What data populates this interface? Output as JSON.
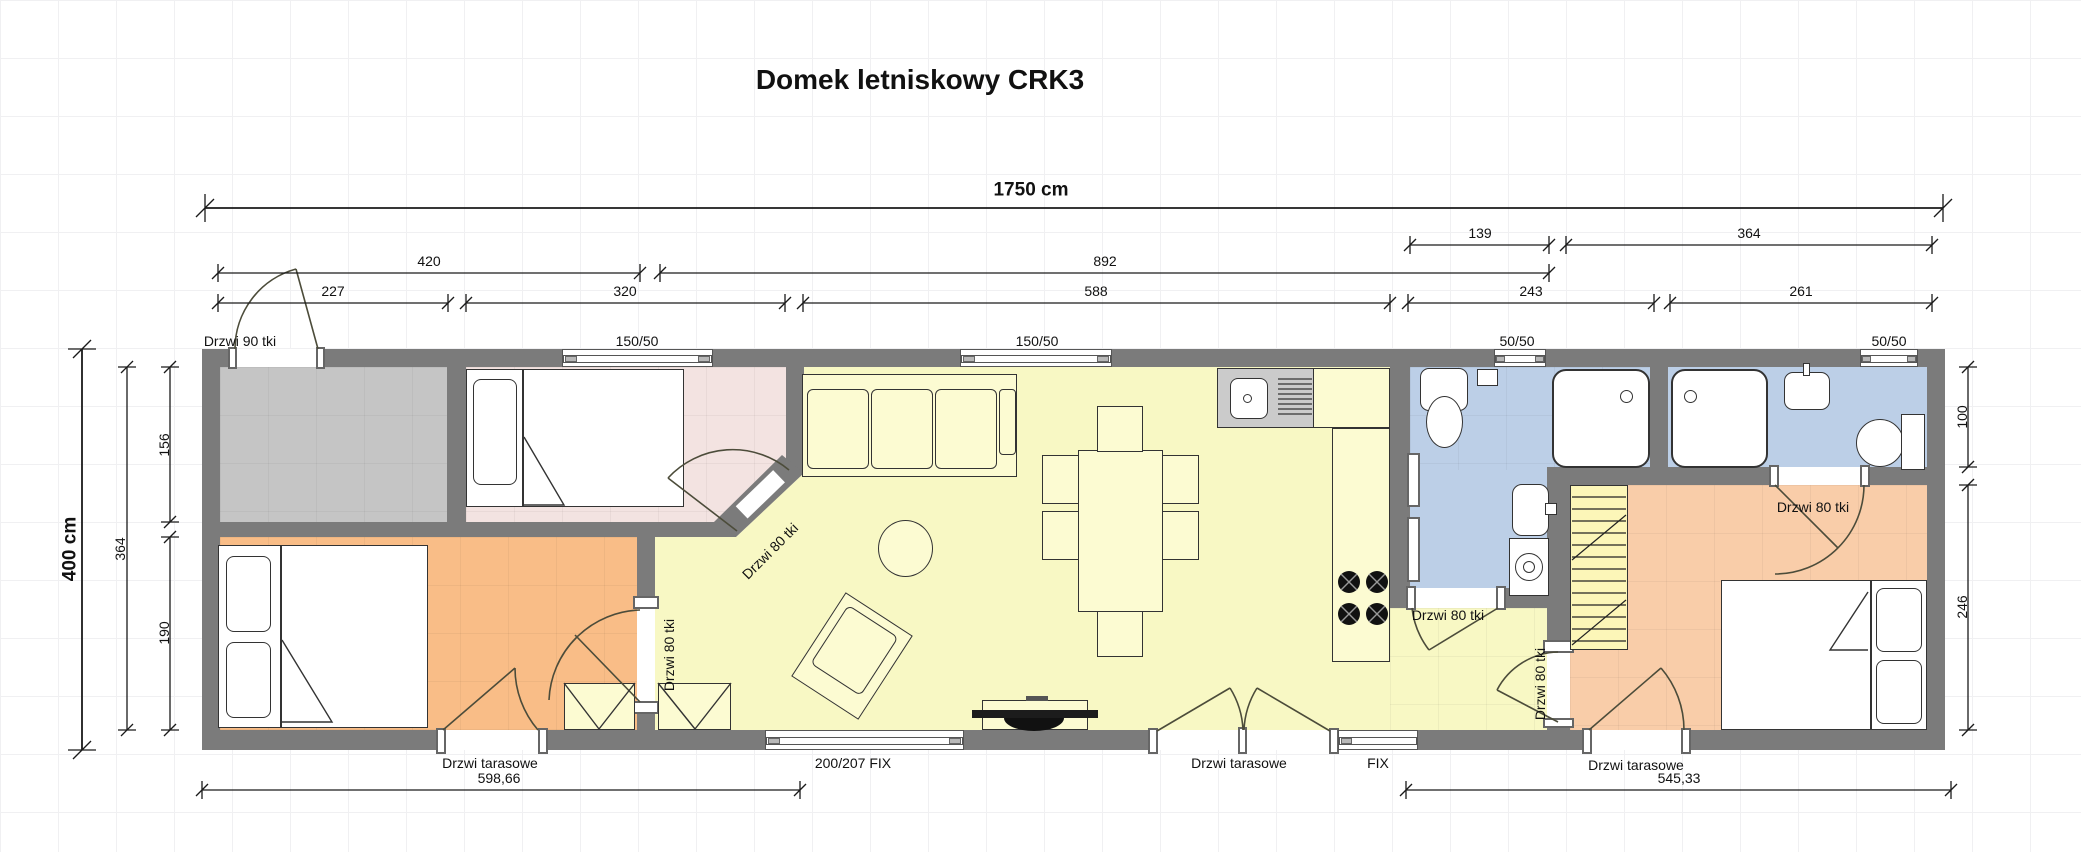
{
  "title": "Domek letniskowy CRK3",
  "dimensions": {
    "total_width": "1750 cm",
    "total_height": "400 cm",
    "row_a": {
      "d139": "139",
      "d364": "364"
    },
    "row_b": {
      "d420": "420",
      "d892": "892"
    },
    "row_c": {
      "d227": "227",
      "d320": "320",
      "d588": "588",
      "d243": "243",
      "d261": "261"
    },
    "left": {
      "d156": "156",
      "d364": "364",
      "d190": "190"
    },
    "right": {
      "d100": "100",
      "d246": "246"
    },
    "bottom": {
      "d598": "598,66",
      "d545": "545,33"
    }
  },
  "openings": {
    "entry_door": "Drzwi 90 tki",
    "window_bedroom1": "150/50",
    "window_living": "150/50",
    "window_bath1": "50/50",
    "window_bath2": "50/50",
    "door_bedroom1": "Drzwi 80 tki",
    "door_bedroom_small": "Drzwi 80 tki",
    "door_bath1": "Drzwi 80 tki",
    "door_bath2": "Drzwi 80 tki",
    "door_bedroom2": "Drzwi 80 tki",
    "terrace_door_1": "Drzwi tarasowe",
    "terrace_door_2": "Drzwi tarasowe",
    "terrace_door_3": "Drzwi tarasowe",
    "fix_window_large": "200/207 FIX",
    "fix_window_small": "FIX"
  },
  "colors": {
    "wall": "#7b7b7b",
    "terrace_floor": "#c5c5c5",
    "bedroom1_floor": "#f3e3e1",
    "bedroom_small_floor": "#f9bd87",
    "living_floor": "#f8f8c4",
    "bathroom_floor": "#bccfe7",
    "bedroom2_floor": "#f9cda9",
    "counter": "#fdfbd0",
    "sink_unit": "#cbcbcb"
  }
}
